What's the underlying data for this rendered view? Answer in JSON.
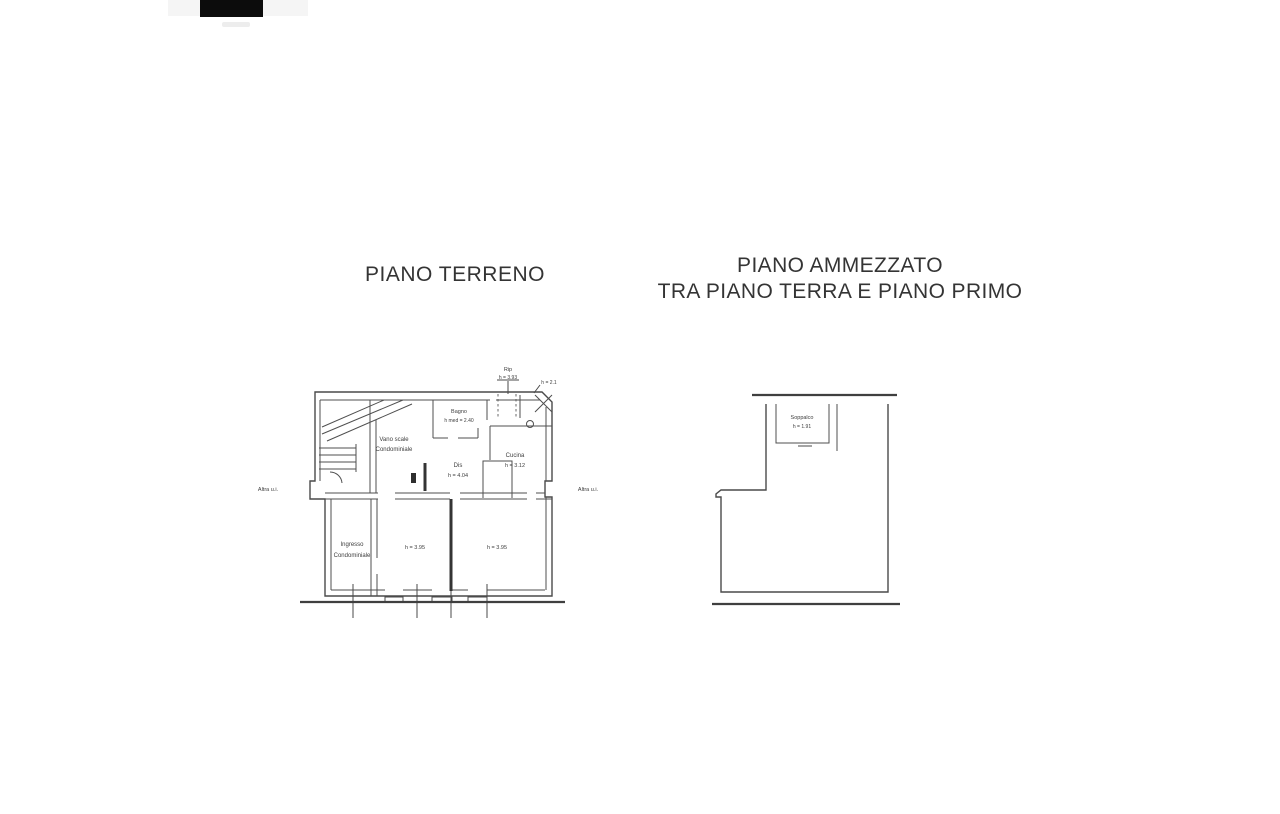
{
  "document": {
    "ground_floor": {
      "title": "PIANO TERRENO",
      "labels": {
        "rip_name": "Rip",
        "rip_height": "h = 3.93",
        "corner_note": "h = 2.1",
        "bagno_name": "Bagno",
        "bagno_height": "h med = 2.40",
        "vano_scale_line1": "Vano scale",
        "vano_scale_line2": "Condominiale",
        "dis_name": "Dis",
        "dis_height": "h = 4.04",
        "cucina_name": "Cucina",
        "cucina_height": "h = 3.12",
        "ingresso_line1": "Ingresso",
        "ingresso_line2": "Condominiale",
        "room_left_height": "h = 3.95",
        "room_right_height": "h = 3.95",
        "altra_ui_left": "Altra u.i.",
        "altra_ui_right": "Altra u.i."
      }
    },
    "mezzanine": {
      "title_line1": "PIANO AMMEZZATO",
      "title_line2": "TRA PIANO TERRA E PIANO PRIMO",
      "labels": {
        "soppalco_name": "Soppalco",
        "soppalco_height": "h = 1.91"
      }
    }
  },
  "colors": {
    "ink": "#4f4f4f",
    "text": "#3d3d3d",
    "title_text": "#343434",
    "artifact_dark": "#0c0c0c",
    "paper": "#ffffff"
  }
}
